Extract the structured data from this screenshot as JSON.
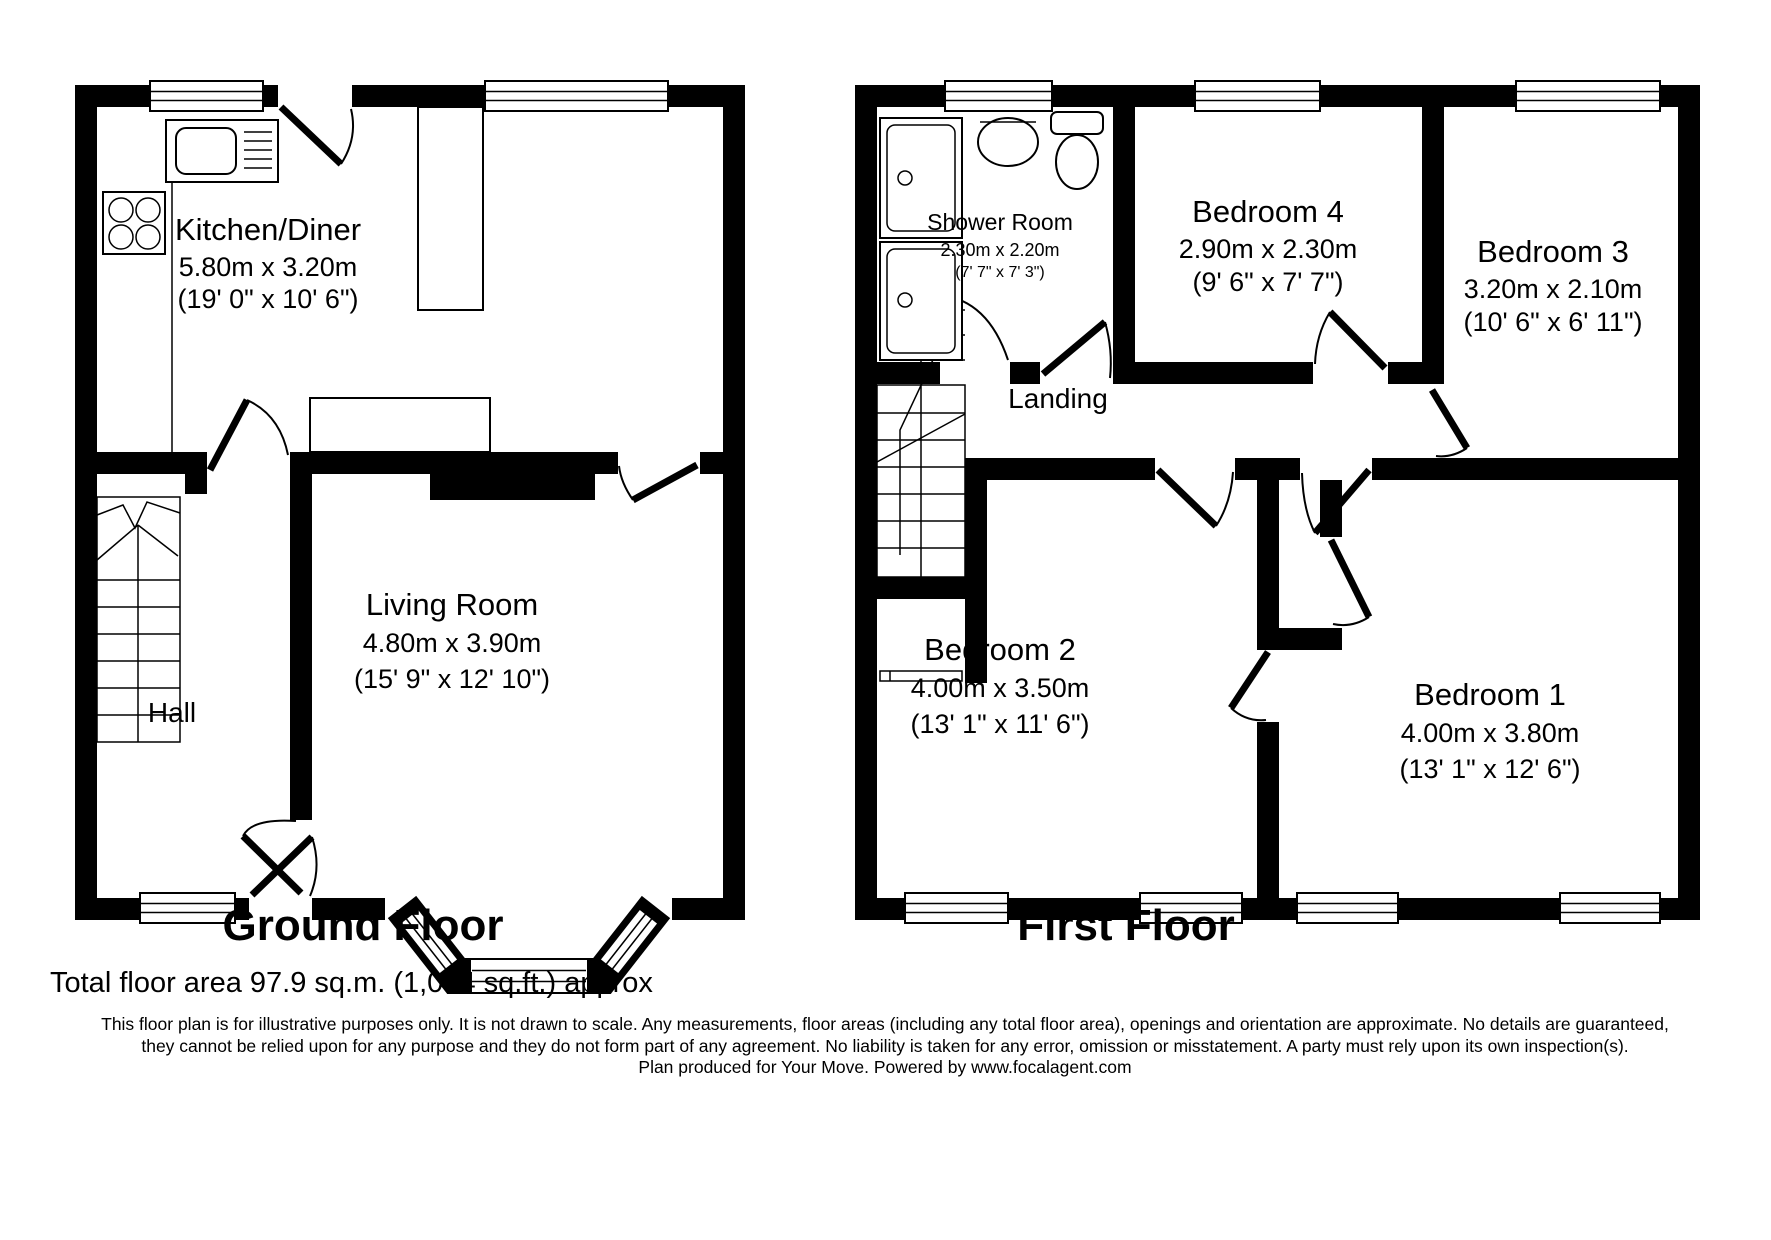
{
  "colors": {
    "wall": "#000000",
    "background": "#ffffff"
  },
  "ground_floor": {
    "title": "Ground Floor",
    "rooms": [
      {
        "name": "Kitchen/Diner",
        "dim_m": "5.80m x 3.20m",
        "dim_ft": "(19' 0\" x 10' 6\")"
      },
      {
        "name": "Living Room",
        "dim_m": "4.80m x 3.90m",
        "dim_ft": "(15' 9\" x 12' 10\")"
      },
      {
        "name": "Hall"
      }
    ]
  },
  "first_floor": {
    "title": "First Floor",
    "rooms": [
      {
        "name": "Shower Room",
        "dim_m": "2.30m x 2.20m",
        "dim_ft": "(7' 7\" x 7' 3\")"
      },
      {
        "name": "Bedroom 4",
        "dim_m": "2.90m x 2.30m",
        "dim_ft": "(9' 6\" x 7' 7\")"
      },
      {
        "name": "Bedroom 3",
        "dim_m": "3.20m x 2.10m",
        "dim_ft": "(10' 6\" x 6' 11\")"
      },
      {
        "name": "Bedroom 2",
        "dim_m": "4.00m x 3.50m",
        "dim_ft": "(13' 1\" x 11' 6\")"
      },
      {
        "name": "Bedroom 1",
        "dim_m": "4.00m x 3.80m",
        "dim_ft": "(13' 1\" x 12' 6\")"
      },
      {
        "name": "Landing"
      }
    ]
  },
  "footer": {
    "total_area": "Total floor area 97.9 sq.m. (1,054 sq.ft.) approx",
    "disclaimer_line1": "This floor plan is for illustrative purposes only. It is not drawn to scale. Any measurements, floor areas (including any total floor area), openings and orientation are approximate. No details are guaranteed,",
    "disclaimer_line2": "they cannot be relied upon for any purpose and they do not form part of any agreement. No liability is taken for any error, omission or misstatement. A party must rely upon its own inspection(s).",
    "disclaimer_line3": "Plan produced for Your Move. Powered by www.focalagent.com"
  }
}
